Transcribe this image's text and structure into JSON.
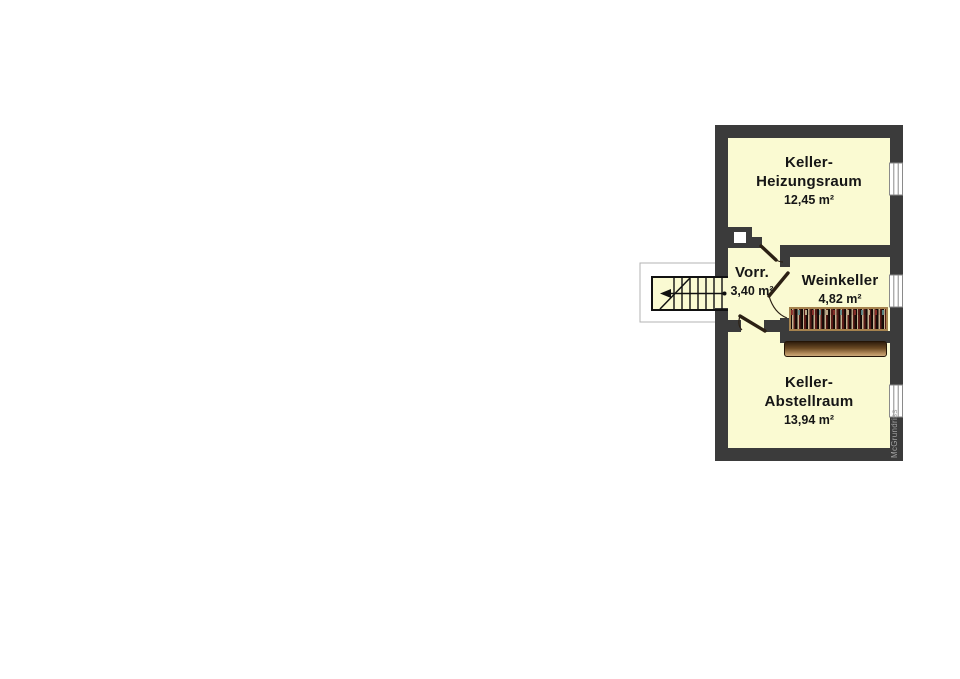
{
  "plan": {
    "watermark": "McGrundriss",
    "rooms": [
      {
        "id": "keller-heizungsraum",
        "lines": [
          "Keller-",
          "Heizungsraum"
        ],
        "area": "12,45 m²"
      },
      {
        "id": "vorraum",
        "lines": [
          "Vorr."
        ],
        "area": "3,40 m²"
      },
      {
        "id": "weinkeller",
        "lines": [
          "Weinkeller"
        ],
        "area": "4,82 m²"
      },
      {
        "id": "keller-abstellraum",
        "lines": [
          "Keller-",
          "Abstellraum"
        ],
        "area": "13,94 m²"
      }
    ],
    "stair": {
      "direction_arrow": "left"
    },
    "colors": {
      "wall": "#3b3b3b",
      "room_fill": "#fafad2",
      "door_leaf": "#2b2014",
      "rack_frame": "#a5824e",
      "rack_interior": "#1c0f08",
      "shelf_dark": "#2f1d0c",
      "shelf_light": "#caa97a",
      "window_fill": "#ffffff",
      "watermark_text": "#a2a2a2"
    }
  }
}
